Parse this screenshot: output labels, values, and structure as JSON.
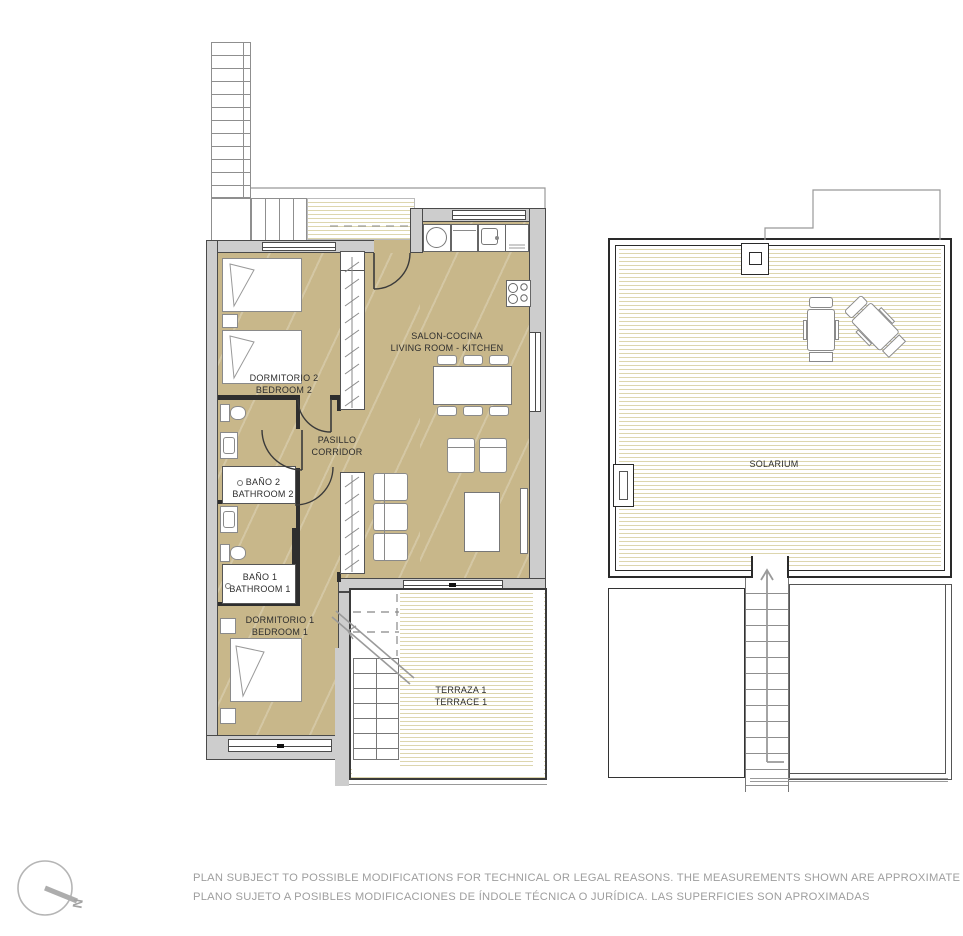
{
  "plan": {
    "title": "apartment-floor-plan",
    "rooms": {
      "bedroom2": {
        "name_es": "DORMITORIO 2",
        "name_en": "BEDROOM 2"
      },
      "living_kitchen": {
        "name_es": "SALON-COCINA",
        "name_en": "LIVING ROOM - KITCHEN"
      },
      "corridor": {
        "name_es": "PASILLO",
        "name_en": "CORRIDOR"
      },
      "bathroom2": {
        "name_es": "BAÑO 2",
        "name_en": "BATHROOM 2"
      },
      "bathroom1": {
        "name_es": "BAÑO 1",
        "name_en": "BATHROOM 1"
      },
      "bedroom1": {
        "name_es": "DORMITORIO 1",
        "name_en": "BEDROOM 1"
      },
      "terrace1": {
        "name_es": "TERRAZA 1",
        "name_en": "TERRACE 1"
      },
      "solarium": {
        "name_es": "SOLARIUM",
        "name_en": ""
      }
    },
    "compass": {
      "label": "N"
    },
    "disclaimer": {
      "line1": "PLAN SUBJECT TO POSSIBLE MODIFICATIONS FOR TECHNICAL OR LEGAL REASONS. THE MEASUREMENTS SHOWN ARE APPROXIMATE",
      "line2": "PLANO SUJETO A POSIBLES MODIFICACIONES DE ÍNDOLE TÉCNICA O JURÍDICA. LAS SUPERFICIES SON APROXIMADAS"
    },
    "colors": {
      "floor_tan": "#c8b78a",
      "floor_stripe": "#ddd6ae",
      "wall_fill": "#cdcdcd",
      "wall_line": "#3a3a3a",
      "furniture_line": "#8a8a8a",
      "label_text": "#2d2d2d",
      "disclaimer_text": "#9e9e9e",
      "compass_gray": "#b2b2b2"
    }
  }
}
